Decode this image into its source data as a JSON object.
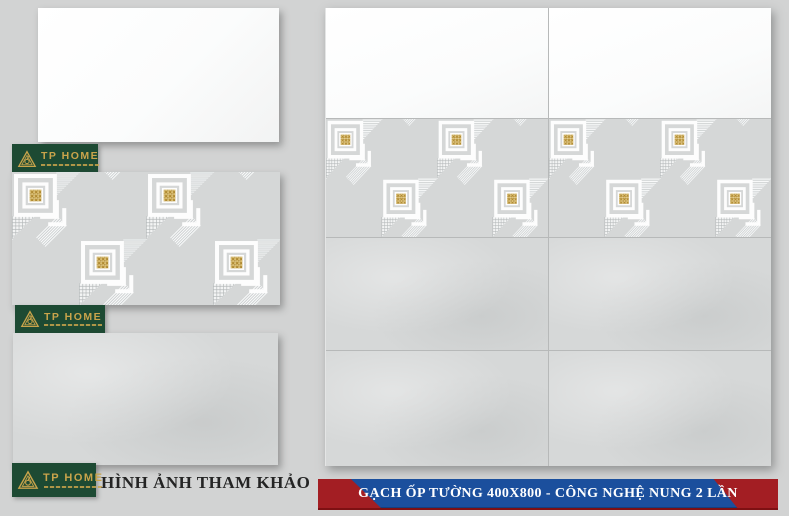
{
  "brand": {
    "name": "TP HOME"
  },
  "caption": {
    "text": "HÌNH ẢNH THAM KHẢO"
  },
  "banner": {
    "text": "GẠCH ỐP TƯỜNG 400X800 - CÔNG NGHỆ NUNG 2 LẦN",
    "bg_color": "#1b4f9d",
    "end_cap_color": "#a31e23",
    "text_color": "#ffffff"
  },
  "samples": [
    {
      "type": "plain-white-tile"
    },
    {
      "type": "geometric-decor-tile-with-gold-squares"
    },
    {
      "type": "plain-grey-tile"
    }
  ],
  "wall_preview": {
    "columns": 2,
    "rows": 4,
    "row_types": [
      "white",
      "decor",
      "grey",
      "grey"
    ]
  },
  "colors": {
    "background": "#d2d3d3",
    "logo_green": "#1d4a33",
    "logo_gold": "#c9a44b",
    "tile_grey": "#d6d8d8",
    "tile_white": "#fcfcfd",
    "gold_accent": "#d9b964",
    "grout": "#b7b9b9"
  }
}
